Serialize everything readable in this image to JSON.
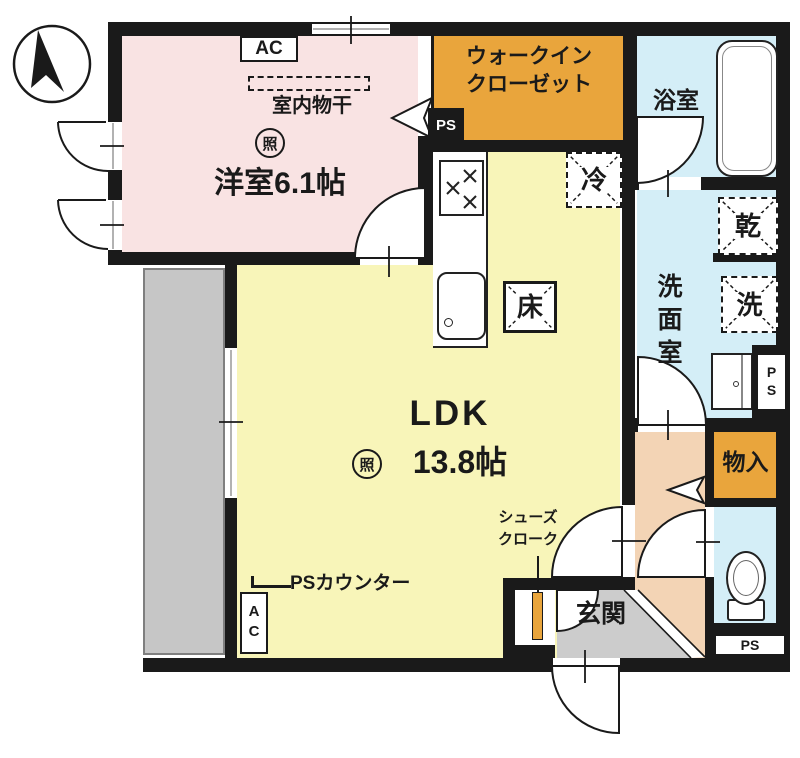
{
  "plan": {
    "bedroom": {
      "label": "洋室6.1帖",
      "ac_unit": "AC",
      "indoor_drying": "室内物干",
      "light_symbol": "照"
    },
    "wic": {
      "label_line1": "ウォークイン",
      "label_line2": "クローゼット"
    },
    "pipe_spaces": {
      "upper": "PS",
      "washroom": "PS",
      "bottom": "PS"
    },
    "bath": {
      "label": "浴室"
    },
    "washroom": {
      "label": "洗面室",
      "dryer_symbol": "乾",
      "washer_symbol": "洗"
    },
    "ldk": {
      "label": "LDK",
      "size": "13.8帖",
      "light_symbol": "照",
      "fridge_symbol": "冷",
      "floor_hatch_symbol": "床",
      "ps_counter_label": "PSカウンター",
      "ac_unit": "AC"
    },
    "storage": {
      "label": "物入"
    },
    "entrance": {
      "label": "玄関"
    },
    "shoe_closet": {
      "label_line1": "シューズ",
      "label_line2": "クローク"
    }
  },
  "colors": {
    "wall": "#1a1a1a",
    "bedroom_pink": "#f9e3e3",
    "ldk_yellow": "#f8f5b9",
    "wic_orange": "#e9a53c",
    "wet_blue": "#d4eef7",
    "hall_peach": "#f3d4b5",
    "entrance_gray": "#cccccc",
    "balcony_gray": "#c6c6c6"
  }
}
